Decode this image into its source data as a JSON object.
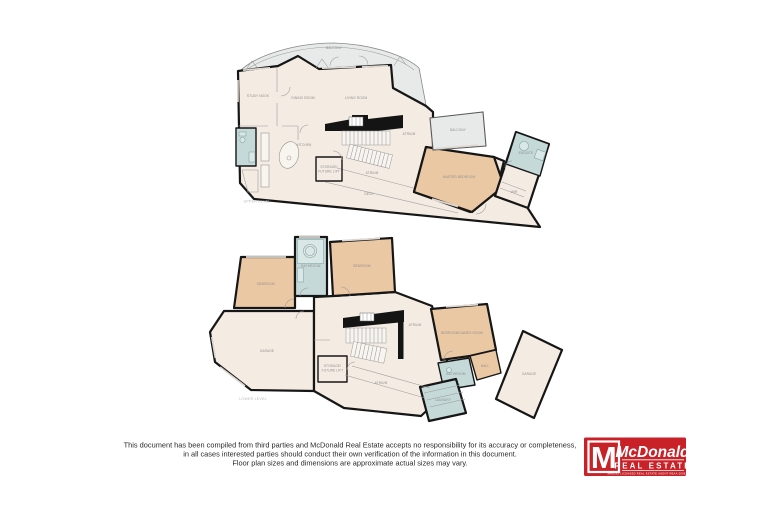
{
  "upper_plan": {
    "caption": "UPPER LEVEL",
    "rooms": {
      "balcony_top": "BALCONY",
      "study": "STUDY NOOK",
      "dining": "DINING ROOM",
      "living": "LIVING ROOM",
      "kitchen": "KITCHEN",
      "storage_line1": "STORAGE/",
      "storage_line2": "FUTURE LIFT",
      "atrium_stair": "ATRIUM",
      "atrium_band": "ATRIUM",
      "deck_band": "DECK",
      "balcony_right": "BALCONY",
      "master": "MASTER BEDROOM",
      "ensuite": "ENSUITE",
      "wir": "WIR"
    }
  },
  "lower_plan": {
    "caption": "LOWER LEVEL",
    "rooms": {
      "bedroom_left": "BEDROOM",
      "bathroom_top": "BATHROOM",
      "bedroom_right": "BEDROOM",
      "garage": "GARAGE",
      "storage_line1": "STORAGE/",
      "storage_line2": "FUTURE LIFT",
      "atrium_hall": "ATRIUM",
      "atrium_lower": "ATRIUM",
      "bed_games": "BEDROOM/GAMES ROOM",
      "hall": "HALL",
      "bathroom": "BATHROOM",
      "laundry": "LAUNDRY",
      "garage_single": "GARAGE"
    }
  },
  "disclaimer": {
    "line1": "This document has been compiled from third parties and McDonald Real Estate accepts no responsibility for its accuracy or completeness,",
    "line2": "in all cases interested parties should conduct their own verification of the information in this document.",
    "line3": "Floor plan sizes and dimensions are approximate actual sizes may vary."
  },
  "logo": {
    "mark": "M",
    "name": "McDonald",
    "subtitle": "REAL ESTATE",
    "fine_print": "MREINZ   LICENSED REAL ESTATE AGENT REAA 2008   MREINZ"
  },
  "colors": {
    "wall": "#161616",
    "room_cream": "#f4ebe2",
    "room_orange": "#ebc8a4",
    "room_wet": "#c4d9d8",
    "room_balcony": "#e8eaea",
    "label_grey": "#8f8f8f",
    "logo_red": "#c92128"
  }
}
